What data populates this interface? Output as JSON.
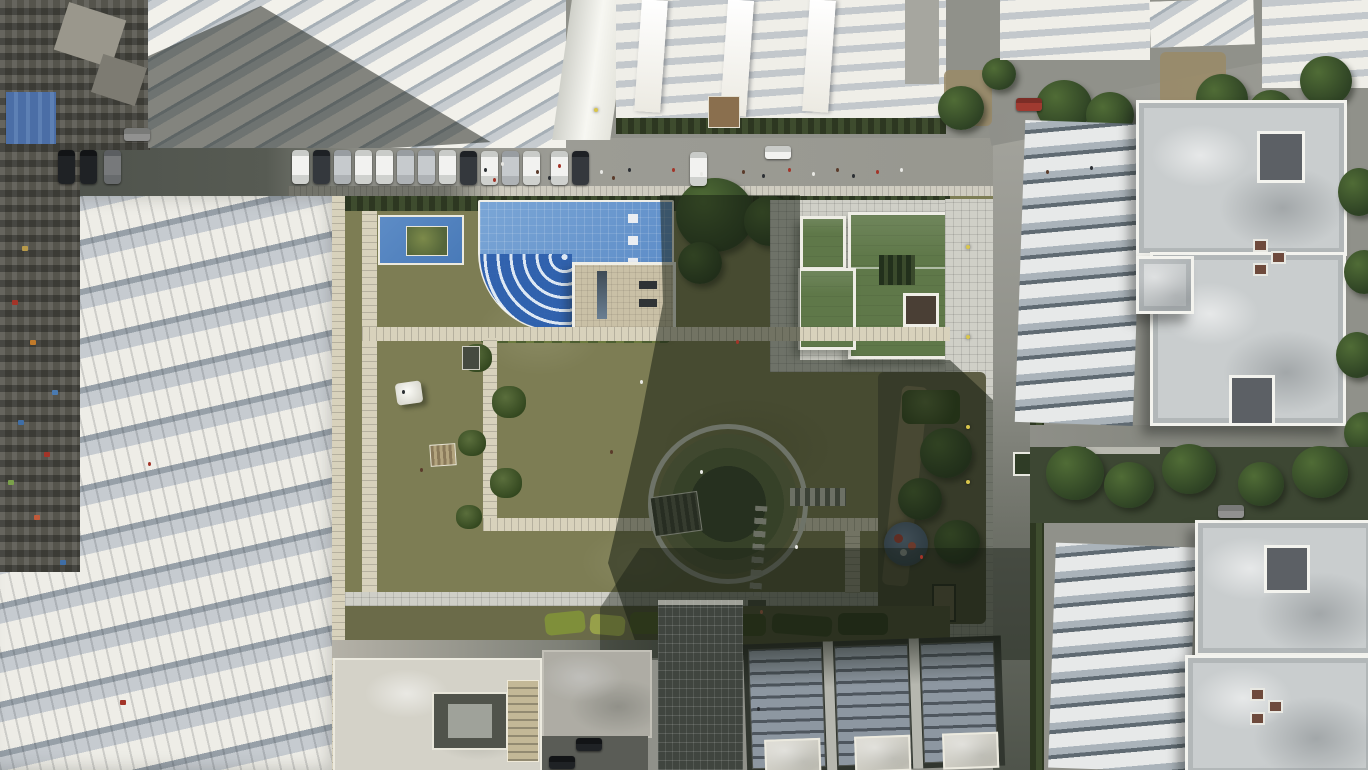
{
  "scene": {
    "type": "aerial-drone-photograph",
    "description": "Top-down aerial view of a modern residential society: a central landscaped courtyard with lawns and stone paths, a blue swimming pool with curved steps, a green-roofed clubhouse, a circular amphitheatre plaza, a small round playground, flower beds, white apartment slabs on the north, a long stepped white apartment complex on the west bordering a dense older neighbourhood, two large white towers on the east separated by a tree-lined road, rooftops with solar panels to the south, and a main road with perpendicular parked cars across the top.",
    "lighting": "low sun from the east casting long shadows across the right half of the courtyard"
  },
  "palette": {
    "road": "#90918a",
    "road-dark": "#545850",
    "sidewalk": "#cfccc0",
    "paver": "#d8d2bc",
    "white-roof": "#edece6",
    "roof-grey": "#c9cdce",
    "facade": "#aeb6bd",
    "facade-dark": "#636d75",
    "concrete": "#d4d2c8",
    "lawn": "#7d7d54",
    "lawn-dark": "#4a5239",
    "hedge": "#3e4c2e",
    "tree": "#2e4224",
    "tree-light": "#506c36",
    "dirt": "#9a8a66",
    "pool": "#6a97cd",
    "pool-deep": "#3a6ab4",
    "deck": "#c9c0a6",
    "club-roof": "#5f7849",
    "solar": "#8d97a1",
    "slum": "#55544c",
    "shadow": "rgba(22,28,18,0.52)",
    "car-white": "#f2f2f0",
    "car-silver": "#c6cacd",
    "car-dark": "#34383d",
    "accent-yellow": "#d9c64b",
    "play-blue": "#4b5f7a",
    "play-red": "#b04038"
  },
  "landmarks": [
    {
      "name": "main-road",
      "detail": "east-west road with perpendicular parked cars and hatched sidewalk"
    },
    {
      "name": "swimming-pool",
      "detail": "blue tiled pool with curved corner steps and small planter pool"
    },
    {
      "name": "clubhouse",
      "detail": "flat green roofs with white parapets beside paved plaza"
    },
    {
      "name": "central-lawn",
      "detail": "olive green lawn crossed by stone paver paths"
    },
    {
      "name": "amphitheatre-circle",
      "detail": "circular sunken plaza with ring path and pergola, in shadow"
    },
    {
      "name": "playground",
      "detail": "small round blue/red play area in shadow"
    },
    {
      "name": "west-apartment-complex",
      "detail": "stepped white slabs with balcony rows"
    },
    {
      "name": "east-towers",
      "detail": "two large white towers with sculpted grey rooftops"
    },
    {
      "name": "old-town",
      "detail": "dense low-rise neighbourhood along the far left edge"
    },
    {
      "name": "solar-rooftops",
      "detail": "south buildings with rows of solar panels, in shadow"
    }
  ],
  "road": {
    "parked_cars": [
      {
        "x": 292,
        "y": 150,
        "c": "white"
      },
      {
        "x": 313,
        "y": 150,
        "c": "dark"
      },
      {
        "x": 334,
        "y": 150,
        "c": "silver"
      },
      {
        "x": 355,
        "y": 150,
        "c": "white"
      },
      {
        "x": 376,
        "y": 150,
        "c": "white"
      },
      {
        "x": 397,
        "y": 150,
        "c": "silver"
      },
      {
        "x": 418,
        "y": 150,
        "c": "silver"
      },
      {
        "x": 439,
        "y": 150,
        "c": "white"
      },
      {
        "x": 460,
        "y": 151,
        "c": "dark"
      },
      {
        "x": 481,
        "y": 151,
        "c": "white"
      },
      {
        "x": 502,
        "y": 151,
        "c": "silver"
      },
      {
        "x": 523,
        "y": 151,
        "c": "white"
      },
      {
        "x": 551,
        "y": 151,
        "c": "white"
      },
      {
        "x": 572,
        "y": 151,
        "c": "dark"
      },
      {
        "x": 690,
        "y": 152,
        "c": "white"
      },
      {
        "x": 58,
        "y": 150,
        "c": "dark dim"
      },
      {
        "x": 80,
        "y": 150,
        "c": "dark dim"
      },
      {
        "x": 104,
        "y": 150,
        "c": "silver dim"
      },
      {
        "x": 765,
        "y": 146,
        "c": "white h"
      },
      {
        "x": 1016,
        "y": 98,
        "c": "red h"
      },
      {
        "x": 1218,
        "y": 505,
        "c": "white h dim"
      },
      {
        "x": 576,
        "y": 738,
        "c": "dark h dim"
      },
      {
        "x": 549,
        "y": 756,
        "c": "dark h dim"
      },
      {
        "x": 124,
        "y": 128,
        "c": "white h dim"
      }
    ]
  },
  "people_colors": [
    "#2b2f33",
    "#a33428",
    "#e8e8e4",
    "#5a3b2a"
  ],
  "people": [
    {
      "x": 484,
      "y": 168
    },
    {
      "x": 493,
      "y": 178
    },
    {
      "x": 501,
      "y": 162
    },
    {
      "x": 536,
      "y": 170
    },
    {
      "x": 548,
      "y": 176
    },
    {
      "x": 558,
      "y": 164
    },
    {
      "x": 600,
      "y": 170
    },
    {
      "x": 612,
      "y": 176
    },
    {
      "x": 628,
      "y": 168
    },
    {
      "x": 672,
      "y": 168
    },
    {
      "x": 700,
      "y": 172
    },
    {
      "x": 742,
      "y": 170
    },
    {
      "x": 762,
      "y": 174
    },
    {
      "x": 788,
      "y": 168
    },
    {
      "x": 812,
      "y": 172
    },
    {
      "x": 836,
      "y": 168
    },
    {
      "x": 852,
      "y": 174
    },
    {
      "x": 876,
      "y": 170
    },
    {
      "x": 900,
      "y": 168
    },
    {
      "x": 1046,
      "y": 170
    },
    {
      "x": 1090,
      "y": 166
    },
    {
      "x": 736,
      "y": 340
    },
    {
      "x": 700,
      "y": 470
    },
    {
      "x": 420,
      "y": 468
    },
    {
      "x": 402,
      "y": 390
    },
    {
      "x": 148,
      "y": 462
    },
    {
      "x": 795,
      "y": 545
    },
    {
      "x": 760,
      "y": 610
    },
    {
      "x": 757,
      "y": 707
    },
    {
      "x": 920,
      "y": 555
    },
    {
      "x": 640,
      "y": 380
    },
    {
      "x": 610,
      "y": 450
    }
  ],
  "lamps": [
    {
      "x": 966,
      "y": 245
    },
    {
      "x": 966,
      "y": 335
    },
    {
      "x": 966,
      "y": 425
    },
    {
      "x": 966,
      "y": 480
    },
    {
      "x": 594,
      "y": 108
    }
  ],
  "old_town_speckles": [
    {
      "x": 12,
      "y": 300,
      "c": "#a33428"
    },
    {
      "x": 30,
      "y": 340,
      "c": "#c07a2a"
    },
    {
      "x": 18,
      "y": 420,
      "c": "#3f6ea6"
    },
    {
      "x": 44,
      "y": 452,
      "c": "#a33428"
    },
    {
      "x": 8,
      "y": 480,
      "c": "#7aa04a"
    },
    {
      "x": 34,
      "y": 515,
      "c": "#c05a3a"
    },
    {
      "x": 52,
      "y": 390,
      "c": "#4a7ab0"
    },
    {
      "x": 22,
      "y": 246,
      "c": "#b89a4a"
    },
    {
      "x": 120,
      "y": 700,
      "c": "#a33428"
    },
    {
      "x": 60,
      "y": 560,
      "c": "#3f6ea6"
    }
  ]
}
